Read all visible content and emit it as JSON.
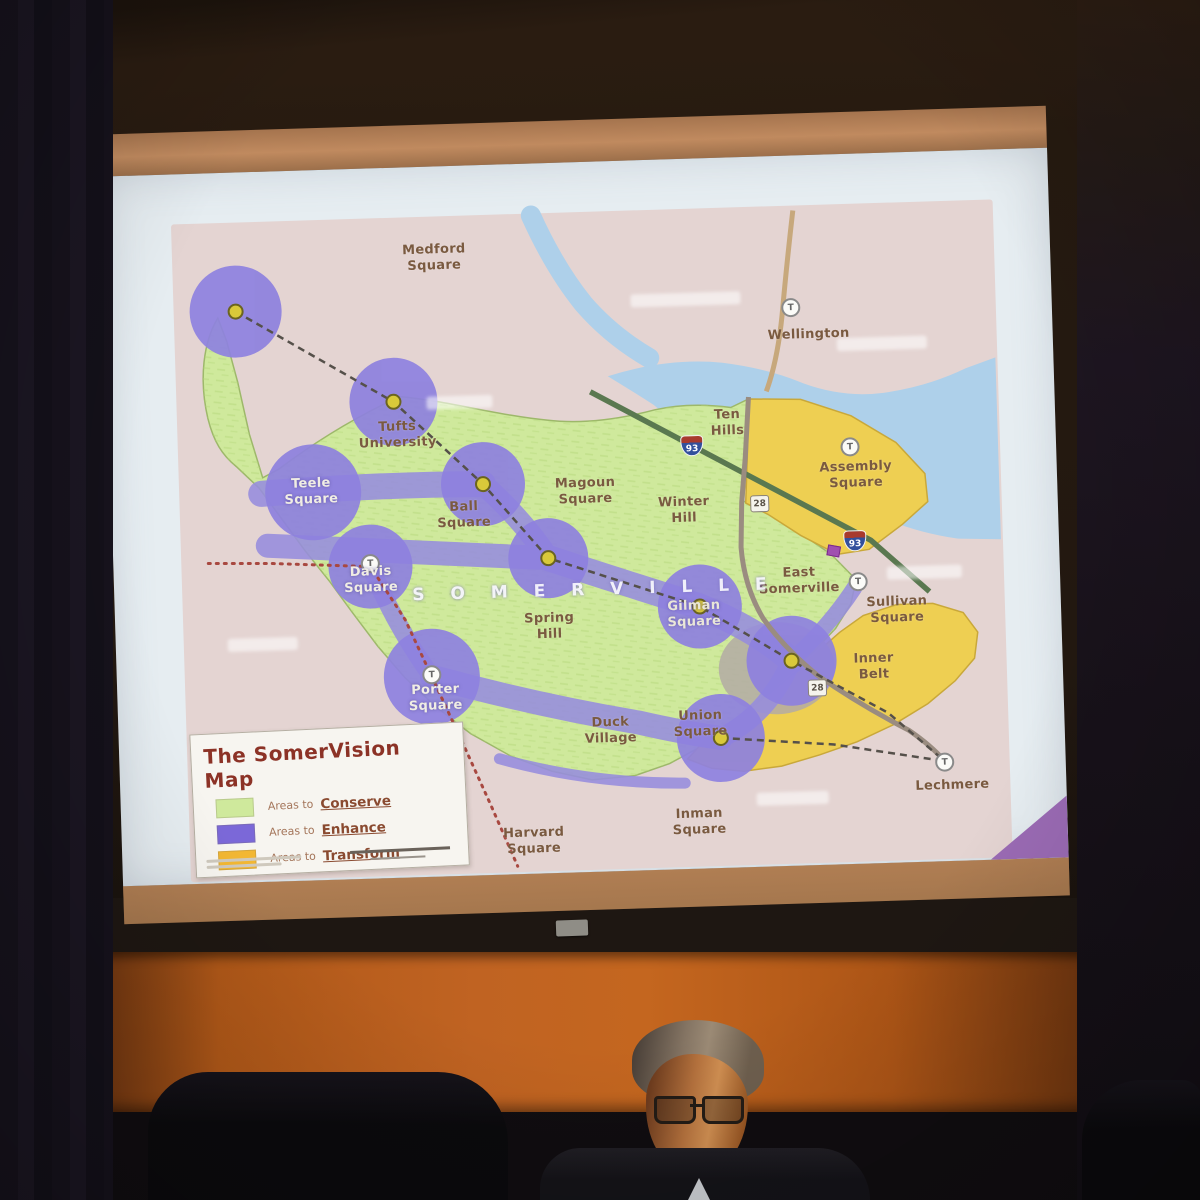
{
  "legend": {
    "title": "The SomerVision Map",
    "items": [
      {
        "prefix": "Areas to",
        "term": "Conserve",
        "color": "#cfe99c"
      },
      {
        "prefix": "Areas to",
        "term": "Enhance",
        "color": "#7b68d8"
      },
      {
        "prefix": "Areas to",
        "term": "Transform",
        "color": "#f2b733"
      }
    ]
  },
  "map": {
    "city_letters": "S O M E R V I L L E",
    "transit_letter": "T",
    "shields": {
      "interstate": "93",
      "route": "28"
    },
    "labels": {
      "medford_square": "Medford\nSquare",
      "wellington": "Wellington",
      "tufts_university": "Tufts\nUniversity",
      "teele_square": "Teele\nSquare",
      "ball_square": "Ball\nSquare",
      "magoun_square": "Magoun\nSquare",
      "winter_hill": "Winter\nHill",
      "ten_hills": "Ten\nHills",
      "assembly_square": "Assembly\nSquare",
      "east_somerville": "East\nSomerville",
      "sullivan_square": "Sullivan\nSquare",
      "spring_hill": "Spring\nHill",
      "gilman_square": "Gilman\nSquare",
      "davis_square": "Davis\nSquare",
      "porter_square": "Porter\nSquare",
      "inner_belt": "Inner\nBelt",
      "duck_village": "Duck\nVillage",
      "union_square": "Union\nSquare",
      "inman_square": "Inman\nSquare",
      "harvard_square": "Harvard\nSquare",
      "lechmere": "Lechmere"
    }
  },
  "colors": {
    "conserve_green": "#cfe99c",
    "enhance_purple": "#8e81df",
    "transform_yellow": "#eecf52",
    "water_blue": "#aed0ea",
    "map_pink": "#e4d4d2",
    "legend_title_red": "#8c3226",
    "wall_orange": "#c06322",
    "screen_frame_tan": "#b8835c"
  }
}
